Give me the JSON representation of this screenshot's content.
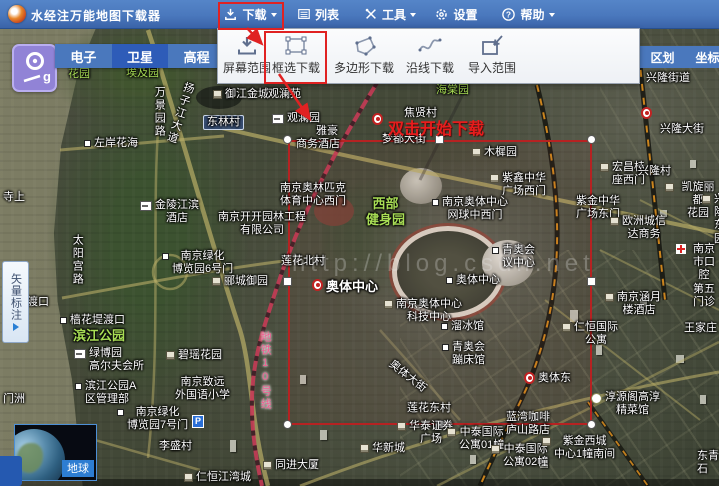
{
  "app": {
    "title": "水经注万能地图下载器"
  },
  "titlebar": {
    "menus": [
      {
        "name": "download",
        "label": "下载",
        "caret": true,
        "highlighted": true
      },
      {
        "name": "list",
        "label": "列表"
      },
      {
        "name": "tools",
        "label": "工具",
        "caret": true
      },
      {
        "name": "settings",
        "label": "设置"
      },
      {
        "name": "help",
        "label": "帮助",
        "caret": true
      }
    ]
  },
  "download_menu": {
    "items": [
      {
        "name": "screen-range",
        "label": "屏幕范围"
      },
      {
        "name": "box-select",
        "label": "框选下载",
        "highlighted": true
      },
      {
        "name": "polygon-download",
        "label": "多边形下载"
      },
      {
        "name": "along-line",
        "label": "沿线下载"
      },
      {
        "name": "import-range",
        "label": "导入范围"
      }
    ]
  },
  "map_type_tabs": {
    "items": [
      {
        "name": "electronic",
        "label": "电子"
      },
      {
        "name": "satellite",
        "label": "卫星",
        "active": true
      },
      {
        "name": "elevation",
        "label": "高程"
      }
    ]
  },
  "right_tabs": {
    "items": [
      {
        "name": "district",
        "label": "区划"
      },
      {
        "name": "coordinates",
        "label": "坐标"
      }
    ]
  },
  "vector_panel": {
    "label": "矢量标注"
  },
  "earth_widget": {
    "label": "地球"
  },
  "tutorial": {
    "hint": "双击开始下载"
  },
  "watermark": "http://blog.csdn.net",
  "colors": {
    "titlebar": "#4a78bd",
    "tab_active": "#2e5cb8",
    "annotation_red": "#e02222",
    "selection_red": "#b62222",
    "park_green": "#a8dd55",
    "metro_pink": "#ef5f92"
  },
  "map_labels": [
    {
      "text": "花园",
      "x": 68,
      "y": 68,
      "cls": "green"
    },
    {
      "text": "埃及园",
      "x": 126,
      "y": 67,
      "cls": "green"
    },
    {
      "text": "万景园路",
      "x": 152,
      "y": 86,
      "cls": "white",
      "vertical": true
    },
    {
      "text": "扬子江大道",
      "x": 183,
      "y": 80,
      "cls": "white",
      "vertical": true,
      "rotate": 18
    },
    {
      "text": "御江金城",
      "x": 213,
      "y": 88,
      "cls": "white",
      "icon": "building"
    },
    {
      "text": "观澜苑",
      "x": 268,
      "y": 88,
      "cls": "white"
    },
    {
      "text": "观澜园",
      "x": 272,
      "y": 112,
      "cls": "white",
      "icon": "hotel"
    },
    {
      "text": "东林村",
      "x": 203,
      "y": 115,
      "cls": "sign"
    },
    {
      "text": "雅豪",
      "x": 316,
      "y": 125,
      "cls": "white"
    },
    {
      "text": "商务酒店",
      "x": 296,
      "y": 138,
      "cls": "white"
    },
    {
      "text": "左岸花海",
      "x": 84,
      "y": 137,
      "cls": "white",
      "dot": true
    },
    {
      "text": "焦贤村",
      "x": 404,
      "y": 107,
      "cls": "white"
    },
    {
      "text": "海棠园",
      "x": 436,
      "y": 84,
      "cls": "green"
    },
    {
      "text": "梦都大街",
      "x": 382,
      "y": 133,
      "cls": "white"
    },
    {
      "text": "兴隆大街",
      "x": 660,
      "y": 123,
      "cls": "white"
    },
    {
      "text": "木樨园",
      "x": 472,
      "y": 146,
      "cls": "white",
      "icon": "building"
    },
    {
      "text": "南京奥林匹克\n体育中心西门",
      "x": 280,
      "y": 182,
      "cls": "white",
      "center": true
    },
    {
      "text": "金陵江滨\n酒店",
      "x": 140,
      "y": 199,
      "cls": "white",
      "center": true,
      "icon": "hotel"
    },
    {
      "text": "南京开开园林工程\n有限公司",
      "x": 218,
      "y": 211,
      "cls": "white",
      "center": true
    },
    {
      "text": "太阳宫路",
      "x": 70,
      "y": 234,
      "cls": "white",
      "vertical": true
    },
    {
      "text": "南京绿化\n博览园6号门",
      "x": 162,
      "y": 250,
      "cls": "white",
      "center": true,
      "dot": true
    },
    {
      "text": "郦城御园",
      "x": 212,
      "y": 275,
      "cls": "white",
      "icon": "building"
    },
    {
      "text": "西部\n健身园",
      "x": 366,
      "y": 196,
      "cls": "green big",
      "center": true
    },
    {
      "text": "南京奥体中心\n网球中西门",
      "x": 432,
      "y": 196,
      "cls": "white",
      "center": true,
      "dot": true
    },
    {
      "text": "紫鑫中华\n广场西门",
      "x": 490,
      "y": 172,
      "cls": "white",
      "center": true,
      "icon": "building"
    },
    {
      "text": "宏昌桂\n座西门",
      "x": 600,
      "y": 161,
      "cls": "white",
      "center": true,
      "icon": "building"
    },
    {
      "text": "兴隆村",
      "x": 638,
      "y": 165,
      "cls": "white"
    },
    {
      "text": "凯旋丽都\n花园",
      "x": 665,
      "y": 181,
      "cls": "white",
      "center": true,
      "icon": "building"
    },
    {
      "text": "兴隆\n东园",
      "x": 702,
      "y": 193,
      "cls": "white",
      "center": true,
      "icon": "building"
    },
    {
      "text": "紫金中华\n广场东门",
      "x": 576,
      "y": 195,
      "cls": "white",
      "center": true
    },
    {
      "text": "欧洲城信\n达商务",
      "x": 610,
      "y": 215,
      "cls": "white",
      "center": true,
      "icon": "building"
    },
    {
      "text": "莲花北村",
      "x": 281,
      "y": 255,
      "cls": "white"
    },
    {
      "text": "奥体中心",
      "x": 312,
      "y": 279,
      "cls": "white big",
      "icon": "metro"
    },
    {
      "text": "青奥会\n议中心",
      "x": 492,
      "y": 244,
      "cls": "white",
      "center": true,
      "dot": true
    },
    {
      "text": "奥体中心",
      "x": 446,
      "y": 274,
      "cls": "white",
      "dot": true
    },
    {
      "text": "南京奥体中心\n科技中心",
      "x": 384,
      "y": 298,
      "cls": "white",
      "center": true,
      "icon": "building"
    },
    {
      "text": "溜冰馆",
      "x": 441,
      "y": 320,
      "cls": "white",
      "dot": true
    },
    {
      "text": "青奥会\n蹦床馆",
      "x": 442,
      "y": 341,
      "cls": "white",
      "center": true,
      "dot": true
    },
    {
      "text": "奥体大街",
      "x": 394,
      "y": 358,
      "cls": "white",
      "rotate": 38
    },
    {
      "text": "樯花堤渡口",
      "x": 60,
      "y": 314,
      "cls": "white",
      "dot": true
    },
    {
      "text": "滨江公园",
      "x": 73,
      "y": 328,
      "cls": "green big"
    },
    {
      "text": "绿博园\n高尔夫会所",
      "x": 74,
      "y": 347,
      "cls": "white",
      "icon": "hotel"
    },
    {
      "text": "碧瑶花园",
      "x": 166,
      "y": 349,
      "cls": "white",
      "icon": "building"
    },
    {
      "text": "地铁10号线",
      "x": 258,
      "y": 331,
      "cls": "pink",
      "vertical": true
    },
    {
      "text": "南京致远\n外国语小学",
      "x": 175,
      "y": 376,
      "cls": "white",
      "center": true
    },
    {
      "text": "滨江公园A\n区管理部",
      "x": 75,
      "y": 380,
      "cls": "white",
      "dot": true
    },
    {
      "text": "南京绿化\n博览园7号门",
      "x": 117,
      "y": 406,
      "cls": "white",
      "center": true,
      "dot": true
    },
    {
      "text": "P",
      "x": 192,
      "y": 415,
      "cls": "parking"
    },
    {
      "text": "李盛村",
      "x": 159,
      "y": 440,
      "cls": "white"
    },
    {
      "text": "仁恒江湾城",
      "x": 184,
      "y": 471,
      "cls": "white",
      "icon": "building"
    },
    {
      "text": "同进大厦",
      "x": 263,
      "y": 459,
      "cls": "white",
      "icon": "building"
    },
    {
      "text": "莲花东村",
      "x": 407,
      "y": 402,
      "cls": "white"
    },
    {
      "text": "华泰证券\n广场",
      "x": 397,
      "y": 420,
      "cls": "white",
      "center": true,
      "icon": "building"
    },
    {
      "text": "中泰国际\n公寓01幢",
      "x": 447,
      "y": 426,
      "cls": "white",
      "center": true,
      "icon": "building"
    },
    {
      "text": "中泰国际\n公寓02幢",
      "x": 491,
      "y": 443,
      "cls": "white",
      "center": true,
      "icon": "building"
    },
    {
      "text": "蓝湾咖啡\n庐山路店",
      "x": 506,
      "y": 411,
      "cls": "white",
      "center": true
    },
    {
      "text": "紫金西城\n中心1幢南间",
      "x": 542,
      "y": 435,
      "cls": "white",
      "center": true,
      "icon": "building"
    },
    {
      "text": "淳源阁高淳\n精菜馆",
      "x": 591,
      "y": 391,
      "cls": "white",
      "center": true,
      "icon": "food"
    },
    {
      "text": "奥体东",
      "x": 524,
      "y": 372,
      "cls": "white",
      "icon": "metro"
    },
    {
      "text": "仁恒国际\n公寓",
      "x": 562,
      "y": 321,
      "cls": "white",
      "center": true,
      "icon": "building"
    },
    {
      "text": "南京涵月\n楼酒店",
      "x": 605,
      "y": 291,
      "cls": "white",
      "center": true,
      "icon": "building"
    },
    {
      "text": "王家庄",
      "x": 684,
      "y": 322,
      "cls": "white"
    },
    {
      "text": "南京市口腔\n第五门诊",
      "x": 676,
      "y": 243,
      "cls": "white",
      "center": true,
      "icon": "cross"
    },
    {
      "text": "东青石",
      "x": 697,
      "y": 450,
      "cls": "white"
    },
    {
      "text": "兴隆街道",
      "x": 646,
      "y": 72,
      "cls": "white"
    },
    {
      "text": "寺上",
      "x": 3,
      "y": 191,
      "cls": "white"
    },
    {
      "text": "渡口",
      "x": 27,
      "y": 296,
      "cls": "white"
    },
    {
      "text": "门洲",
      "x": 3,
      "y": 393,
      "cls": "white"
    },
    {
      "text": "华新城",
      "x": 360,
      "y": 442,
      "cls": "white",
      "icon": "building"
    },
    {
      "text": "",
      "x": 372,
      "y": 113,
      "cls": "white",
      "icon": "metro"
    },
    {
      "text": "",
      "x": 641,
      "y": 107,
      "cls": "white",
      "icon": "metro"
    }
  ]
}
